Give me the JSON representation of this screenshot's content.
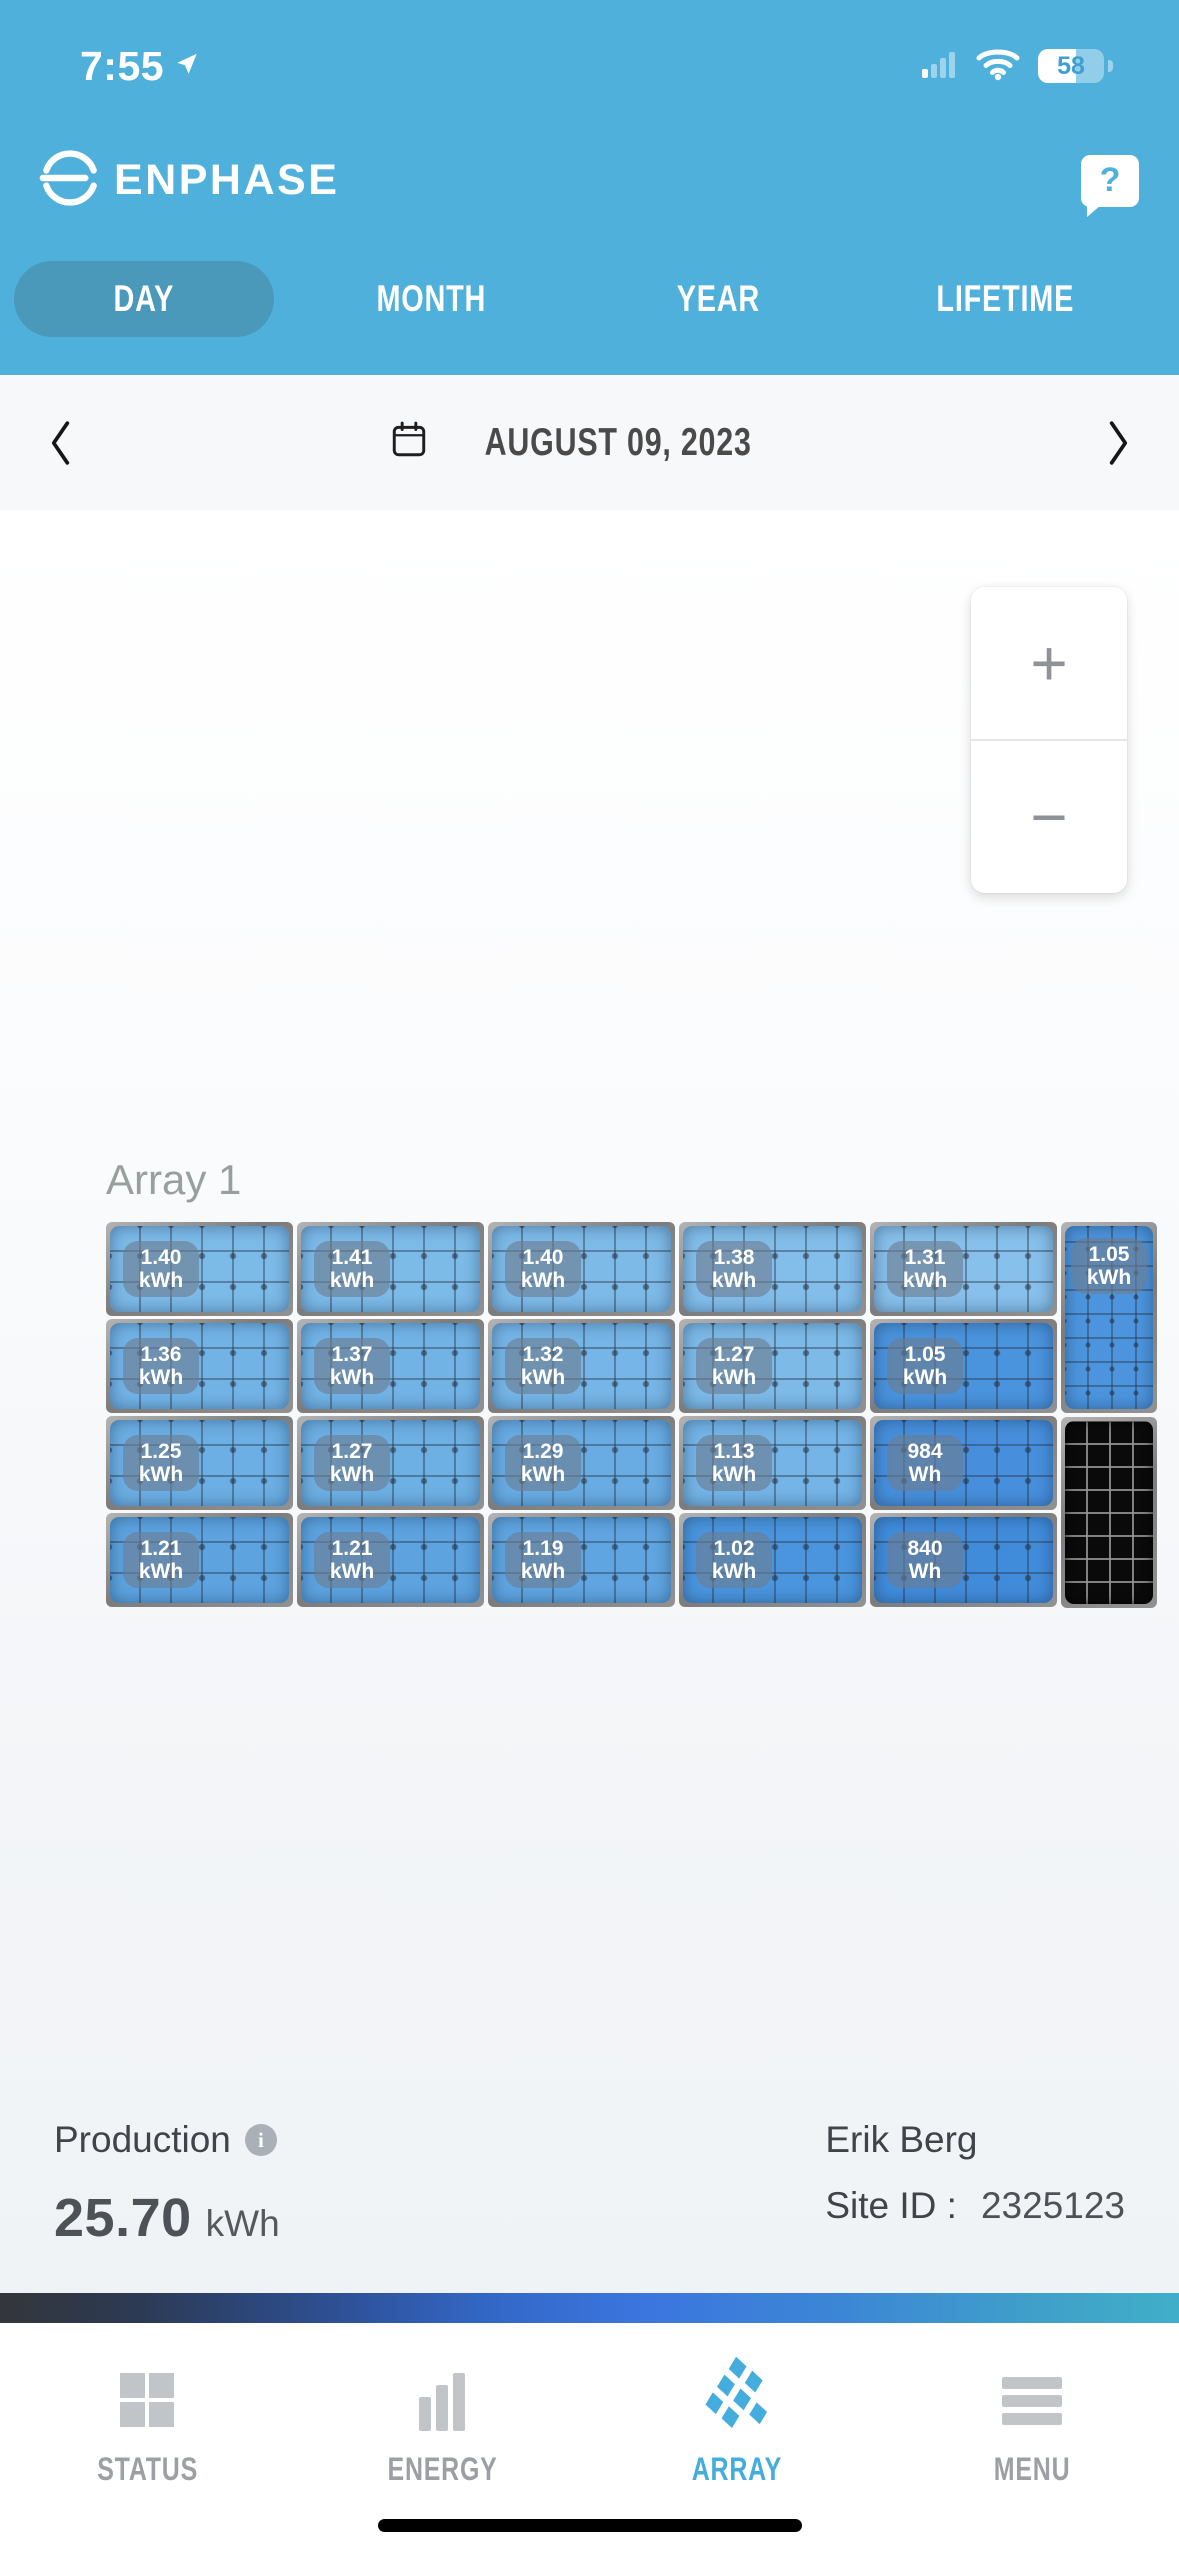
{
  "status_bar": {
    "time": "7:55",
    "battery_percent": "58"
  },
  "header": {
    "brand": "ENPHASE",
    "help_label": "?"
  },
  "period_tabs": {
    "items": [
      {
        "label": "DAY",
        "active": true
      },
      {
        "label": "MONTH",
        "active": false
      },
      {
        "label": "YEAR",
        "active": false
      },
      {
        "label": "LIFETIME",
        "active": false
      }
    ]
  },
  "date_nav": {
    "date": "AUGUST 09, 2023"
  },
  "zoom_controls": {
    "zoom_in": "+",
    "zoom_out": "−"
  },
  "array": {
    "label": "Array 1",
    "rows": [
      [
        {
          "value": "1.40",
          "unit": "kWh",
          "color": "#7CBAE8"
        },
        {
          "value": "1.41",
          "unit": "kWh",
          "color": "#7CBAE8"
        },
        {
          "value": "1.40",
          "unit": "kWh",
          "color": "#7DBAE8"
        },
        {
          "value": "1.38",
          "unit": "kWh",
          "color": "#83BEEA"
        },
        {
          "value": "1.31",
          "unit": "kWh",
          "color": "#87C0EB"
        }
      ],
      [
        {
          "value": "1.36",
          "unit": "kWh",
          "color": "#72B3E6"
        },
        {
          "value": "1.37",
          "unit": "kWh",
          "color": "#72B3E6"
        },
        {
          "value": "1.32",
          "unit": "kWh",
          "color": "#76B5E7"
        },
        {
          "value": "1.27",
          "unit": "kWh",
          "color": "#7DBAE8"
        },
        {
          "value": "1.05",
          "unit": "kWh",
          "color": "#4A93DD"
        }
      ],
      [
        {
          "value": "1.25",
          "unit": "kWh",
          "color": "#6CAFE4"
        },
        {
          "value": "1.27",
          "unit": "kWh",
          "color": "#6DB0E4"
        },
        {
          "value": "1.29",
          "unit": "kWh",
          "color": "#68ACE3"
        },
        {
          "value": "1.13",
          "unit": "kWh",
          "color": "#74B4E6"
        },
        {
          "value": "984",
          "unit": "Wh",
          "color": "#478FDC"
        }
      ],
      [
        {
          "value": "1.21",
          "unit": "kWh",
          "color": "#5CA3E0"
        },
        {
          "value": "1.21",
          "unit": "kWh",
          "color": "#5CA3E0"
        },
        {
          "value": "1.19",
          "unit": "kWh",
          "color": "#5FA5E1"
        },
        {
          "value": "1.02",
          "unit": "kWh",
          "color": "#4A95DE"
        },
        {
          "value": "840",
          "unit": "Wh",
          "color": "#418CDA"
        }
      ]
    ],
    "side_panels": [
      {
        "value": "1.05",
        "unit": "kWh",
        "color": "#4C95DE",
        "style": "portrait"
      },
      {
        "value": "",
        "unit": "",
        "color": "#0A0A0A",
        "style": "portrait-inactive"
      }
    ]
  },
  "summary": {
    "production_label": "Production",
    "production_value": "25.70",
    "production_unit": "kWh",
    "owner_name": "Erik Berg",
    "site_id_label": "Site ID :",
    "site_id_value": "2325123"
  },
  "nav_bar": {
    "items": [
      {
        "label": "STATUS",
        "icon": "status-grid",
        "active": false
      },
      {
        "label": "ENERGY",
        "icon": "energy-bars",
        "active": false
      },
      {
        "label": "ARRAY",
        "icon": "array-panels",
        "active": true
      },
      {
        "label": "MENU",
        "icon": "menu-lines",
        "active": false
      }
    ],
    "active_color": "#45ACDE"
  },
  "colors": {
    "header_blue": "#4FB0DC",
    "active_pill": "#4A98BA",
    "accent_blue": "#45ACDE",
    "badge_bg": "rgba(108,124,144,0.62)",
    "gradient_bar": [
      "#33363B",
      "#2D4F93",
      "#3B76DF",
      "#41AEC9"
    ]
  }
}
